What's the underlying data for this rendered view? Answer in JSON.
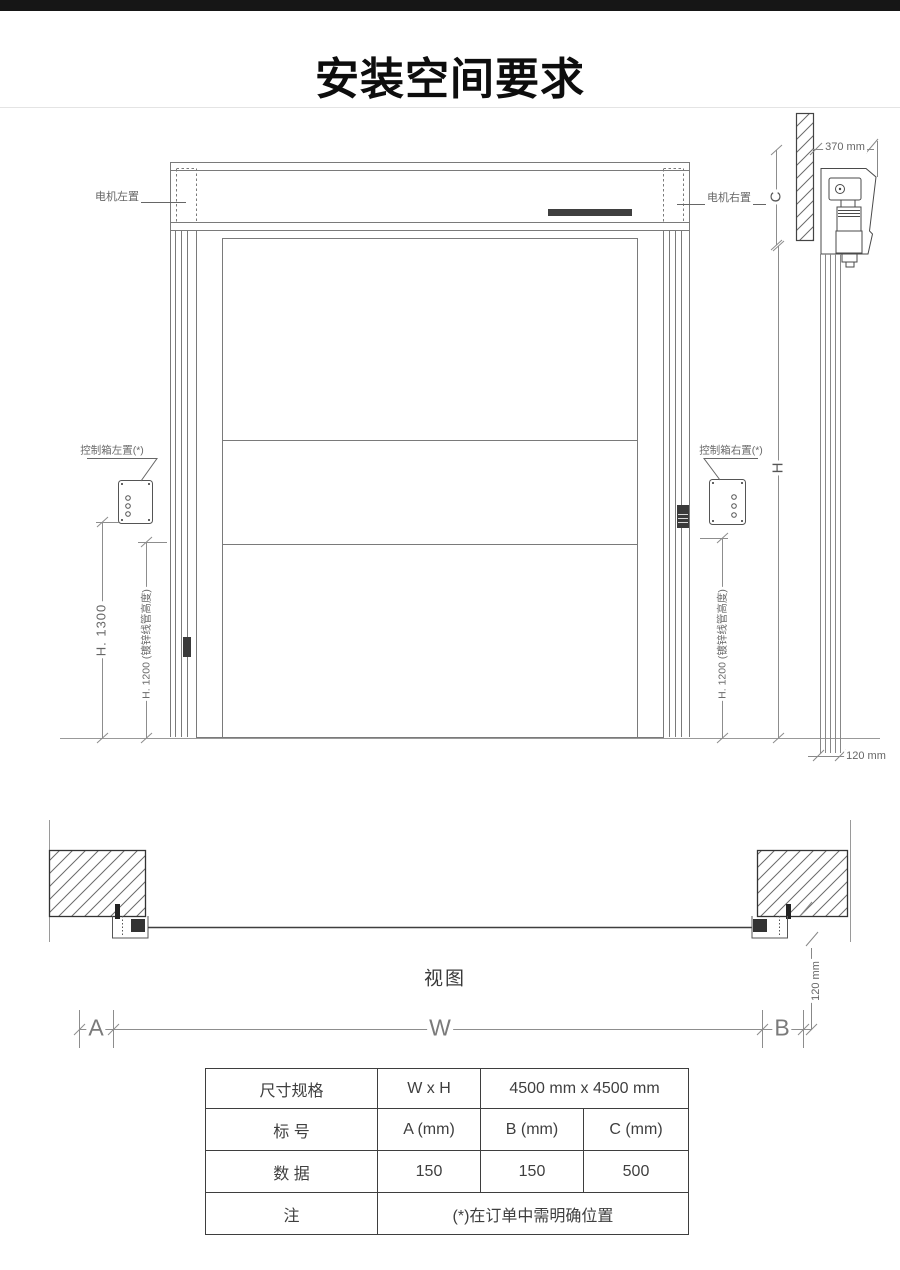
{
  "page": {
    "title": "安装空间要求"
  },
  "colors": {
    "top_bar": "#161616",
    "drawing_line": "#7a7a7a",
    "dimension_line": "#8d8d8d",
    "dark_fill": "#3a3a3a",
    "table_border": "#3e3e3e"
  },
  "elevation": {
    "motor_left_label": "电机左置",
    "motor_right_label": "电机右置",
    "control_left_label": "控制箱左置(*)",
    "control_right_label": "控制箱右置(*)",
    "dim_h1300": "H. 1300",
    "dim_h1200_left": "H. 1200 (镀锌线管高度)",
    "dim_h1200_right": "H. 1200 (镀锌线管高度)",
    "dim_h": "H",
    "dim_c": "C",
    "dim_370": "370 mm",
    "dim_120_side": "120 mm"
  },
  "plan": {
    "view_label": "视图",
    "dim_a": "A",
    "dim_w": "W",
    "dim_b": "B",
    "dim_120": "120 mm"
  },
  "table": {
    "spec_row": {
      "label": "尺寸规格",
      "key": "W x H",
      "value": "4500 mm x 4500 mm"
    },
    "header_row": {
      "label": "标 号",
      "a": "A (mm)",
      "b": "B (mm)",
      "c": "C (mm)"
    },
    "data_row": {
      "label": "数 据",
      "a": "150",
      "b": "150",
      "c": "500"
    },
    "note_row": {
      "label": "注",
      "value": "(*)在订单中需明确位置"
    }
  }
}
